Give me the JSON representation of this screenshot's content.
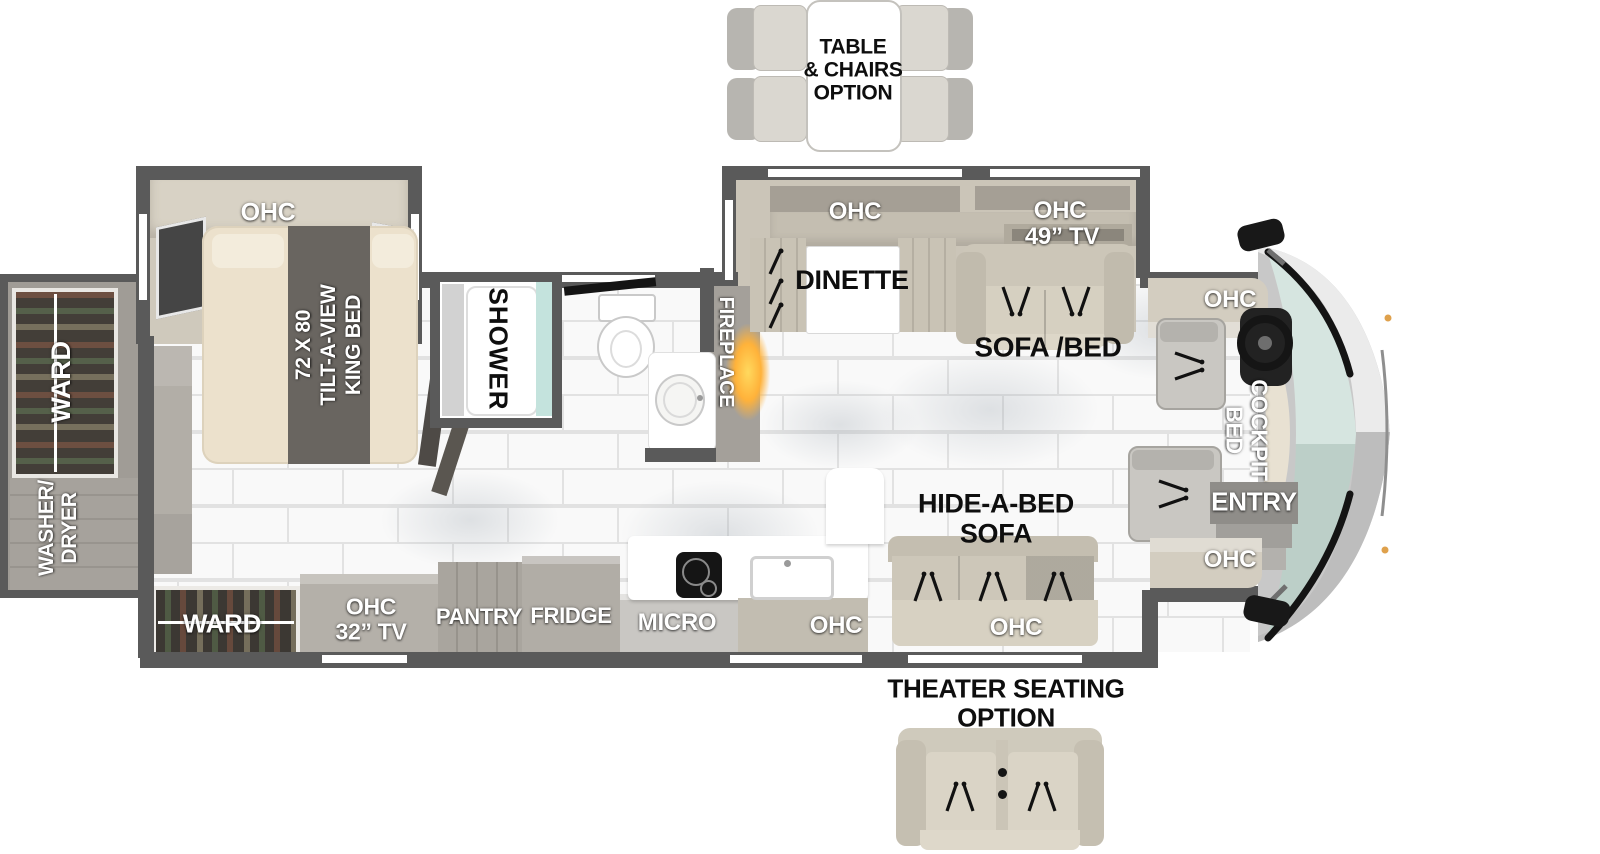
{
  "options": {
    "table_chairs_label": "TABLE\n& CHAIRS\nOPTION",
    "theater_label": "THEATER SEATING\nOPTION"
  },
  "bedroom": {
    "ohc": "OHC",
    "king_bed": "72 X 80\nTILT-A-VIEW\nKING BED"
  },
  "bath": {
    "shower": "SHOWER"
  },
  "living": {
    "fireplace": "FIREPLACE",
    "dinette_ohc": "OHC",
    "dinette": "DINETTE",
    "tv_ohc": "OHC",
    "tv_size": "49” TV",
    "sofa_bed": "SOFA /BED",
    "hide_a_bed": "HIDE-A-BED\nSOFA",
    "hide_a_bed_ohc": "OHC"
  },
  "kitchen": {
    "micro": "MICRO",
    "counter_ohc": "OHC",
    "pantry": "PANTRY",
    "fridge": "FRIDGE"
  },
  "rear": {
    "ward": "WARD",
    "washer_dryer": "WASHER/\nDRYER"
  },
  "bottom_row": {
    "ward": "WARD",
    "ohc_tv": "OHC\n32” TV"
  },
  "cockpit": {
    "ohc_top": "OHC",
    "bed": "COCKPIT\nBED",
    "entry": "ENTRY",
    "ohc_bottom": "OHC"
  },
  "colors": {
    "wall": "#5a5a5a",
    "slide_interior": "#cbc5b8",
    "cabinet_gray": "#aeaaa3",
    "sofa_cream": "#d6d0c2",
    "bed_cream": "#ece1cc",
    "bed_band": "#696560",
    "shower_glass": "#c4e3dd",
    "windshield_top": "#d6e5e0",
    "windshield_bottom": "#bccfc8",
    "flame_orange": "#ffb23a",
    "floor_tile": "#f9f9f9"
  }
}
